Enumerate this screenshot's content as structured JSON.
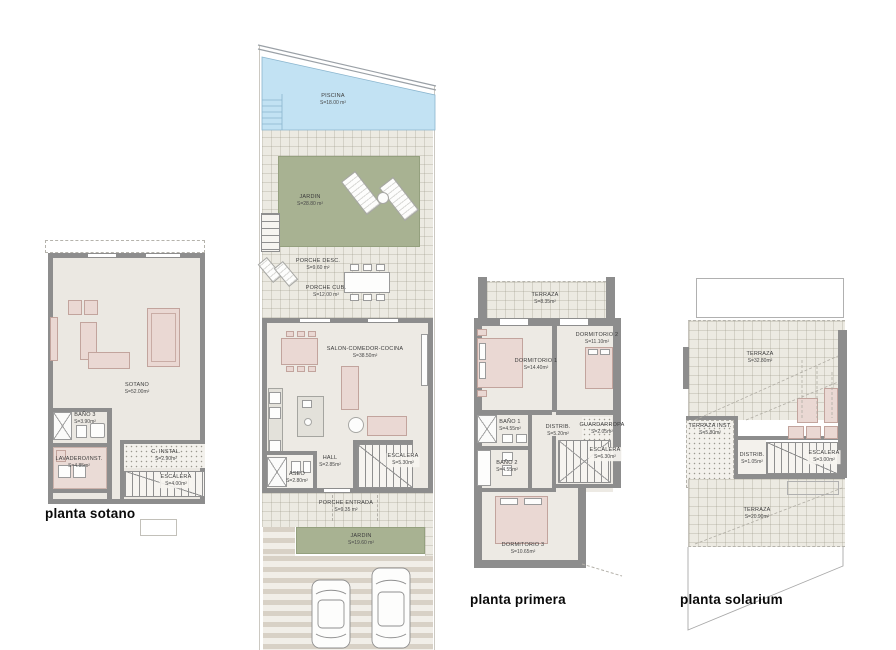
{
  "colors": {
    "wall": "#8d8d8d",
    "floor": "#ebe8e2",
    "tile_floor": "#eceae2",
    "garden_green": "#a8b292",
    "pool_blue": "#c2e2f3",
    "furniture_pink": "#ead8d3",
    "paving_stripe": "#d8d1c6"
  },
  "plans": {
    "sotano": {
      "title": "planta sotano",
      "rooms": [
        {
          "name": "SOTANO",
          "area": "S=52.00m²"
        },
        {
          "name": "BAÑO 3",
          "area": "S=3.90m²"
        },
        {
          "name": "LAVADERO/INST.",
          "area": "S=4.85m²"
        },
        {
          "name": "C. INSTAL.",
          "area": "S=2.90m²"
        },
        {
          "name": "ESCALERA",
          "area": "S=4.00m²"
        }
      ]
    },
    "baja": {
      "rooms": [
        {
          "name": "PISCINA",
          "area": "S=18.00 m²"
        },
        {
          "name": "JARDIN",
          "area": "S=28.80 m²"
        },
        {
          "name": "PORCHE DESC.",
          "area": "S=9.60 m²"
        },
        {
          "name": "PORCHE CUB.",
          "area": "S=12.00 m²"
        },
        {
          "name": "SALON-COMEDOR-COCINA",
          "area": "S=38.50m²"
        },
        {
          "name": "HALL",
          "area": "S=2.85m²"
        },
        {
          "name": "ASEO",
          "area": "S=2.80m²"
        },
        {
          "name": "ESCALERA",
          "area": "S=5.30m²"
        },
        {
          "name": "PORCHE ENTRADA",
          "area": "S=9.35 m²"
        },
        {
          "name": "JARDIN",
          "area": "S=19.60 m²"
        }
      ]
    },
    "primera": {
      "title": "planta primera",
      "rooms": [
        {
          "name": "TERRAZA",
          "area": "S=8.35m²"
        },
        {
          "name": "DORMITORIO 1",
          "area": "S=14.40m²"
        },
        {
          "name": "DORMITORIO 2",
          "area": "S=11.10m²"
        },
        {
          "name": "BAÑO 1",
          "area": "S=4.55m²"
        },
        {
          "name": "DISTRIB.",
          "area": "S=5.20m²"
        },
        {
          "name": "GUARDARROPA",
          "area": "S=2.05m²"
        },
        {
          "name": "BAÑO 2",
          "area": "S=4.55m²"
        },
        {
          "name": "ESCALERA",
          "area": "S=6.30m²"
        },
        {
          "name": "DORMITORIO 3",
          "area": "S=10.65m²"
        }
      ]
    },
    "solarium": {
      "title": "planta solarium",
      "rooms": [
        {
          "name": "TERRAZA",
          "area": "S=32.80m²"
        },
        {
          "name": "TERRAZA INST.",
          "area": "S=5.80m²"
        },
        {
          "name": "DISTRIB.",
          "area": "S=1.05m²"
        },
        {
          "name": "ESCALERA",
          "area": "S=3.00m²"
        },
        {
          "name": "TERRAZA",
          "area": "S=20.90m²"
        }
      ]
    }
  }
}
